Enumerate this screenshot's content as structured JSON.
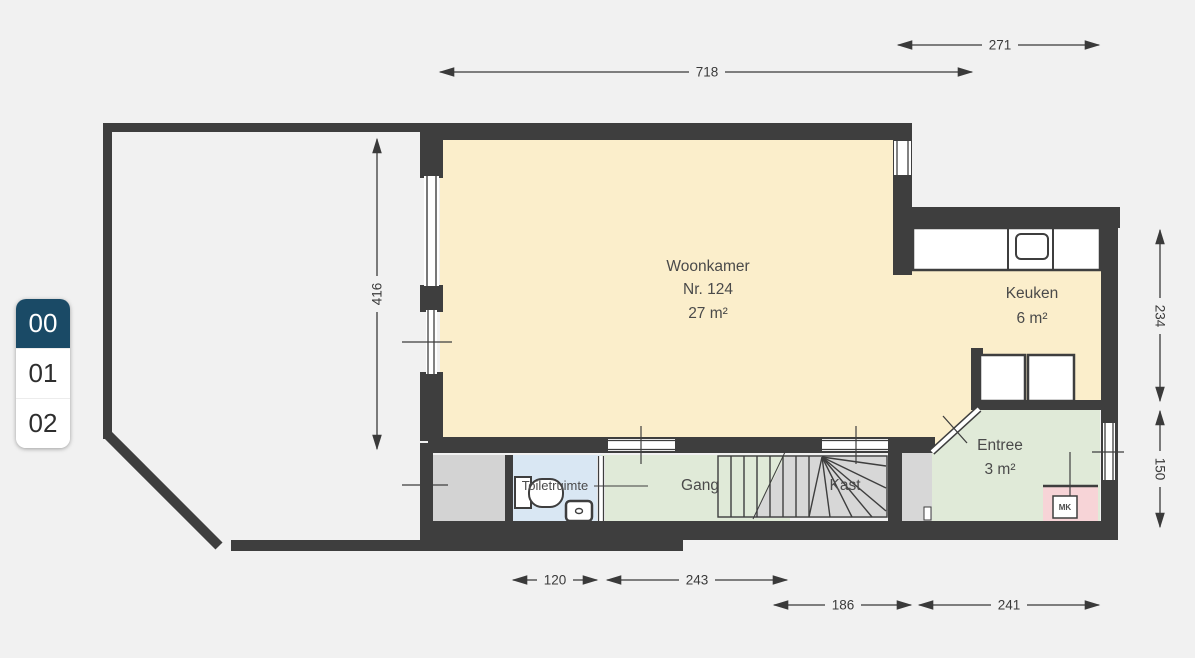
{
  "floor_selector": {
    "selected_index": 0,
    "selected_color": "#1A4A66",
    "floors": [
      {
        "label": "00"
      },
      {
        "label": "01"
      },
      {
        "label": "02"
      }
    ]
  },
  "plan": {
    "rooms": {
      "woonkamer": {
        "name": "Woonkamer",
        "number": "Nr. 124",
        "area": "27 m²",
        "color": "#FBEECB"
      },
      "keuken": {
        "name": "Keuken",
        "area": "6 m²",
        "color": "#FBEECB"
      },
      "entree": {
        "name": "Entree",
        "area": "3 m²",
        "color": "#E0EAD8"
      },
      "gang": {
        "name": "Gang",
        "color": "#E0EAD8"
      },
      "kast": {
        "name": "Kast",
        "color": "#D7D7D7"
      },
      "toiletruimte": {
        "name": "Toiletruimte",
        "color": "#D9E7F3"
      },
      "meterkast": {
        "label": "MK",
        "color": "#F7D4D7"
      }
    },
    "fixtures": [
      "kitchen-counter",
      "kitchen-sink",
      "appliance",
      "appliance",
      "toilet",
      "washbasin",
      "meter-cabinet",
      "stairs"
    ],
    "dimensions": {
      "top": "718",
      "top_right": "271",
      "left": "416",
      "right_top": "234",
      "right_bottom": "150",
      "bottom_row1": [
        "120",
        "243"
      ],
      "bottom_row2": [
        "186",
        "241"
      ]
    },
    "colors": {
      "wall": "#3E3E3E",
      "background": "#F1F1F1"
    }
  }
}
